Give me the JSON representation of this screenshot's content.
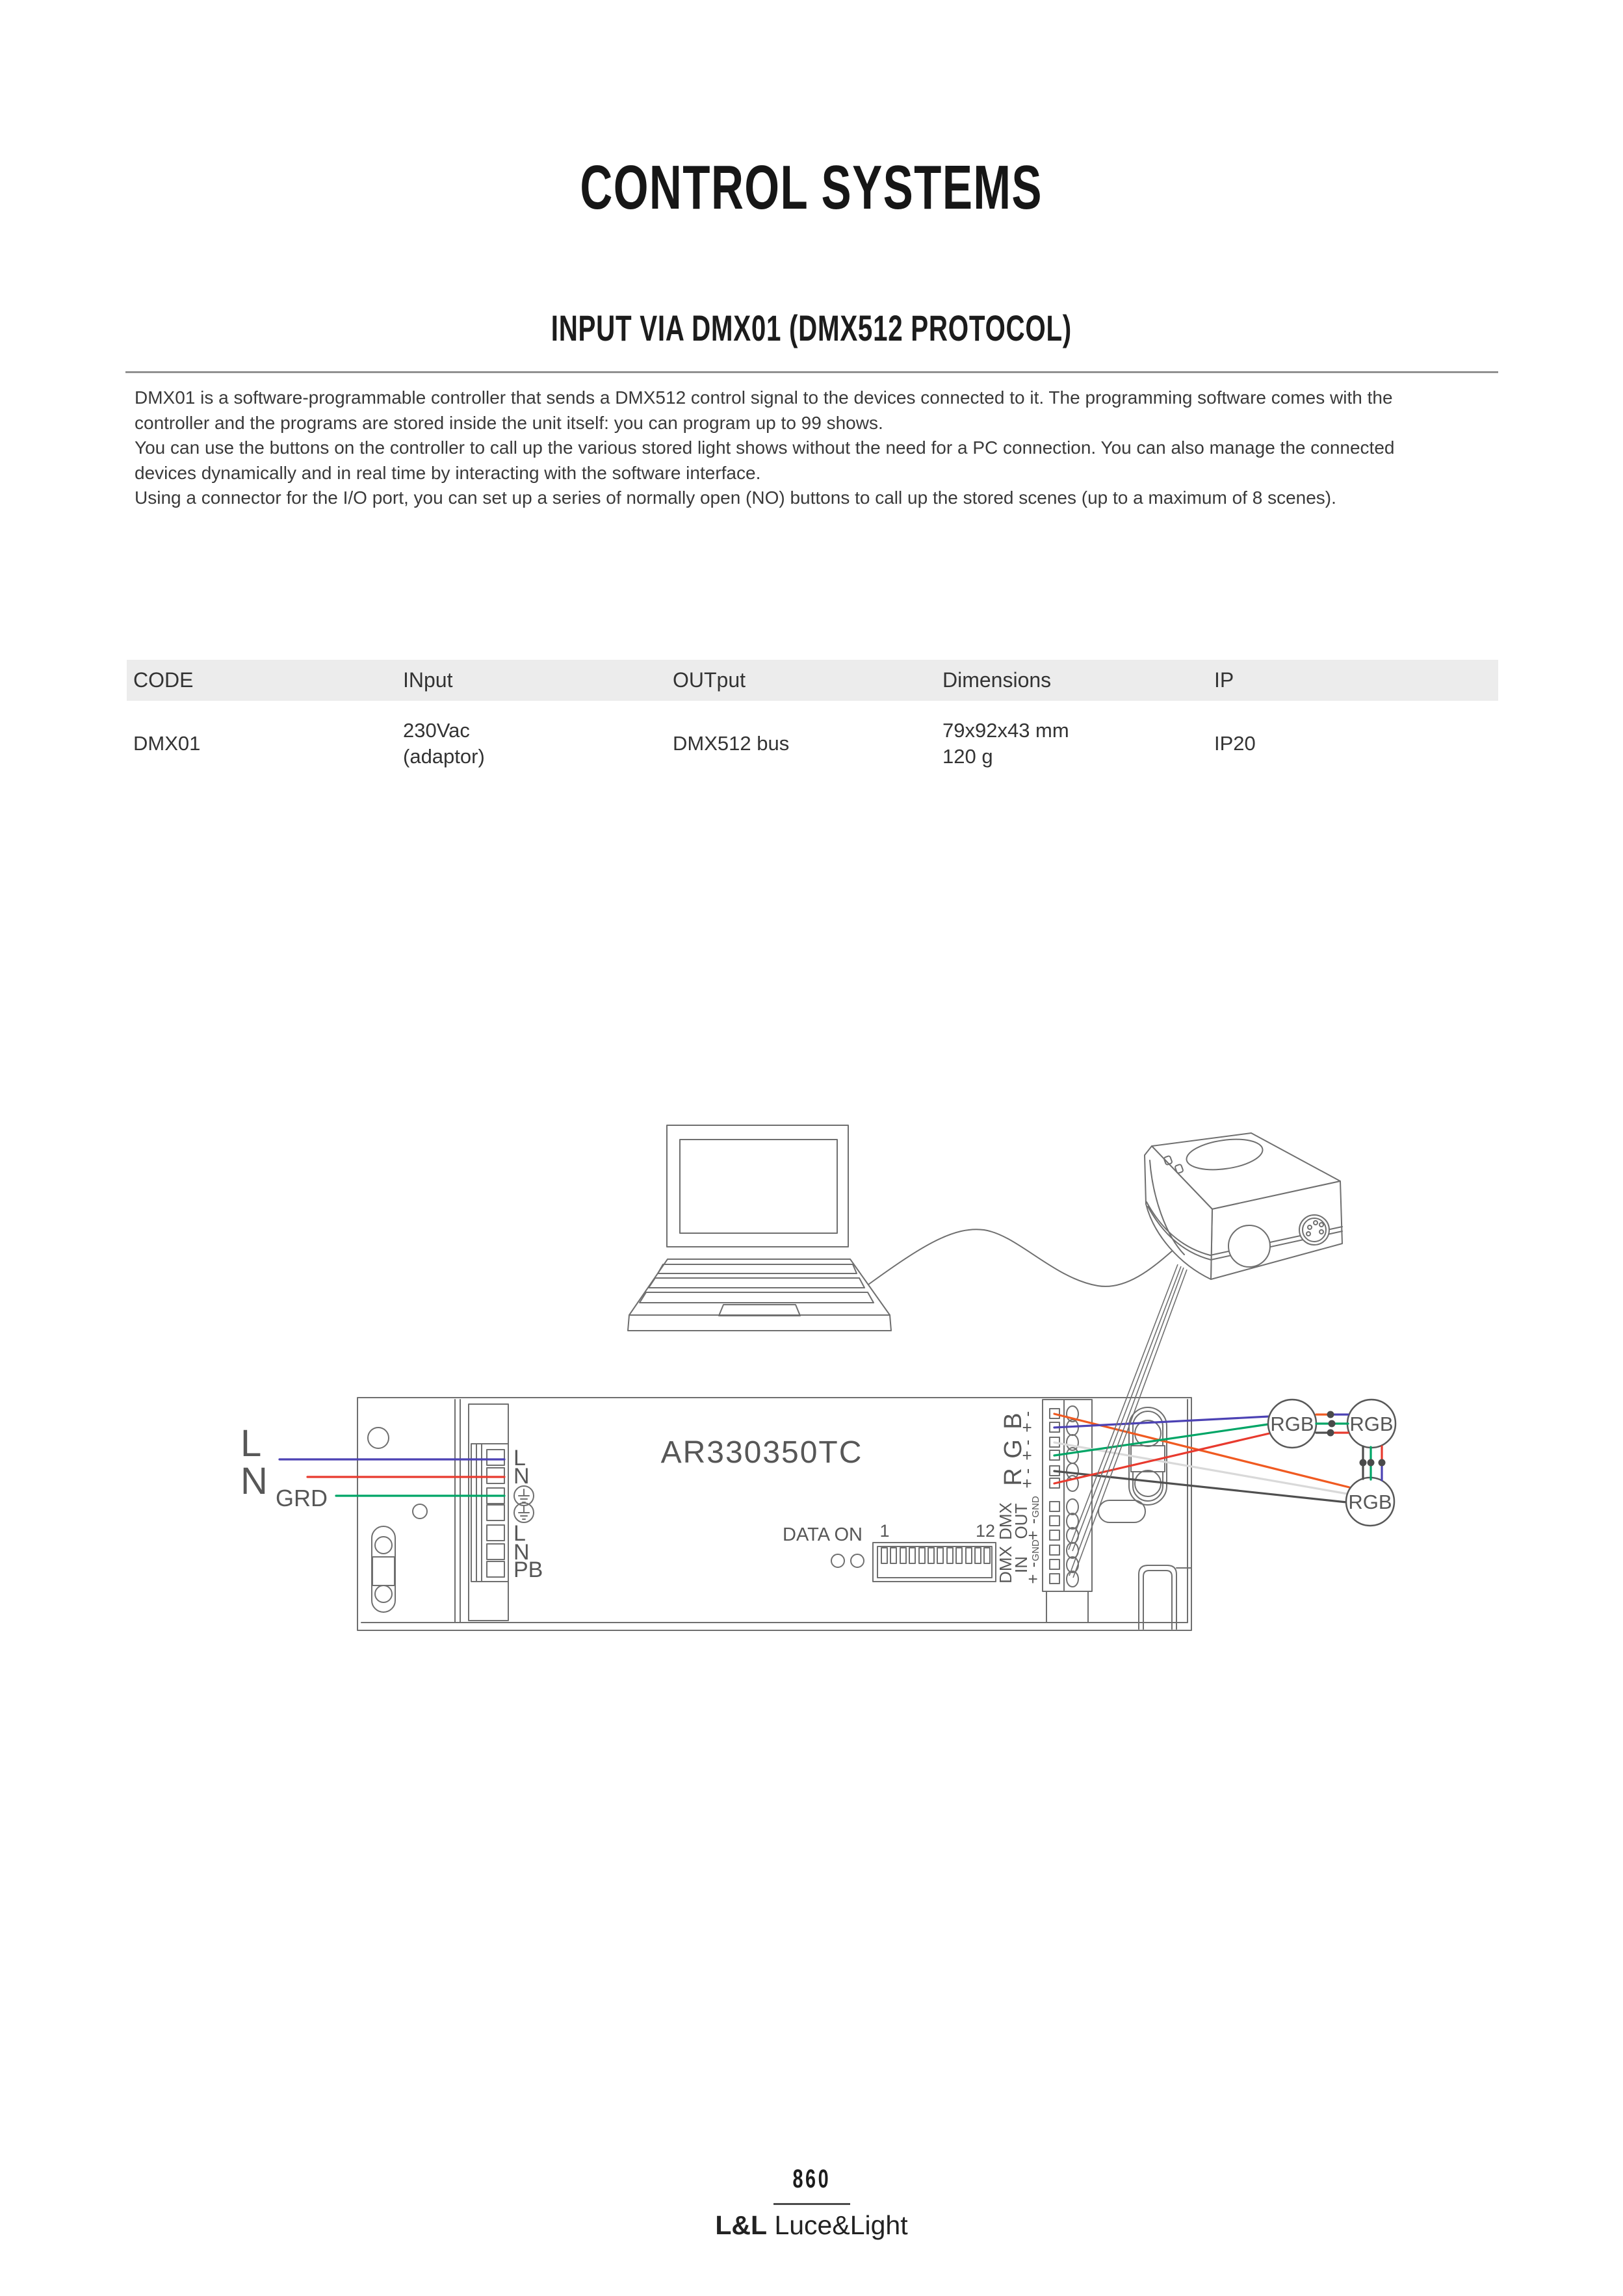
{
  "page": {
    "title": "CONTROL SYSTEMS",
    "section_title": "INPUT VIA DMX01 (DMX512 PROTOCOL)",
    "description_lines": [
      "DMX01 is a software-programmable controller that sends a DMX512 control signal to the devices connected to it. The programming software comes with the",
      "controller and the programs are stored inside the unit itself: you can program up to 99 shows.",
      "You can use the buttons on the controller to call up the various stored light shows without the need for a PC connection. You can also manage the connected",
      "devices dynamically and in real time by interacting with the software interface.",
      "Using a connector for the I/O port, you can set up a series of normally open (NO) buttons to call up the stored scenes (up to a maximum of 8 scenes)."
    ],
    "footer": {
      "page_number": "860",
      "brand_bold": "L&L",
      "brand_rest": " Luce&Light"
    }
  },
  "table": {
    "headers": [
      "CODE",
      "INput",
      "OUTput",
      "Dimensions",
      "IP"
    ],
    "row": {
      "code": "DMX01",
      "input_line1": "230Vac",
      "input_line2": "(adaptor)",
      "output": "DMX512 bus",
      "dim_line1": "79x92x43 mm",
      "dim_line2": "120 g",
      "ip": "IP20"
    }
  },
  "diagram": {
    "driver_label": "AR330350TC",
    "data_on_label": "DATA ON",
    "dip": {
      "first": "1",
      "last": "12"
    },
    "mains": {
      "live": "L",
      "neutral": "N",
      "ground": "GRD"
    },
    "power_terminals": [
      "L",
      "N",
      "L",
      "N",
      "PB"
    ],
    "channels": {
      "b": "B",
      "g": "G",
      "r": "R"
    },
    "polarity": {
      "plus": "+",
      "minus": "-"
    },
    "dmx_labels": {
      "dmx": "DMX",
      "out": "OUT",
      "in": "IN",
      "gnd": "GND"
    },
    "fixture_label": "RGB",
    "colors": {
      "blue": "#4c42b4",
      "red": "#e83a2e",
      "green": "#00a566",
      "orange": "#f05a21",
      "light_gray": "#d9d9d9",
      "dark_gray": "#4f4f4f"
    }
  }
}
